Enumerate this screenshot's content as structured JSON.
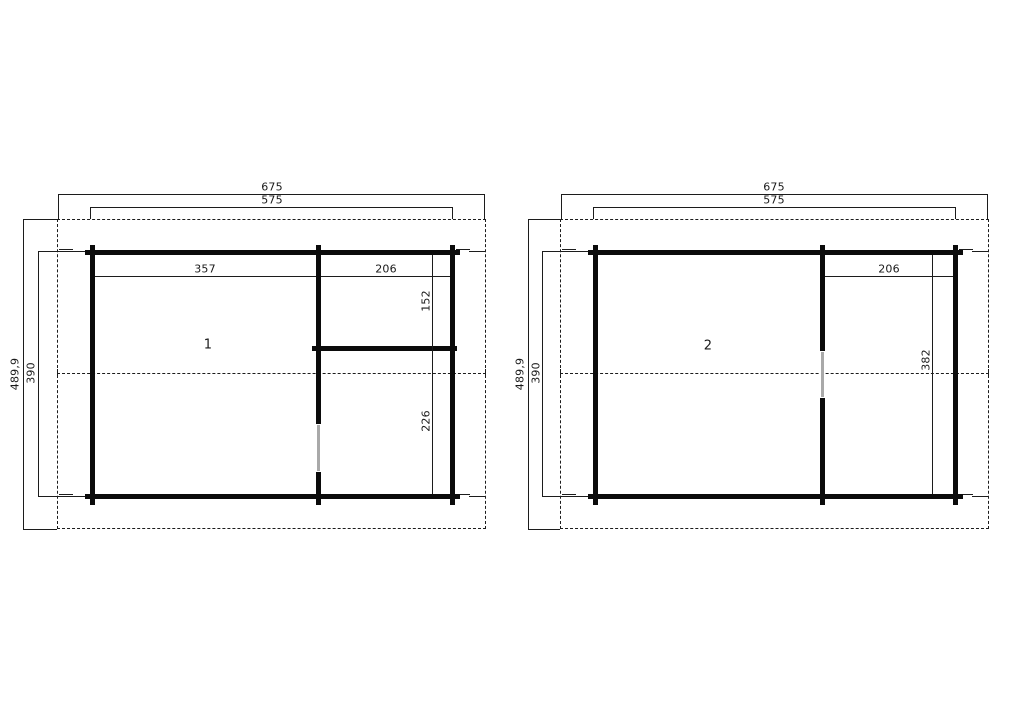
{
  "colors": {
    "line": "#1c1c1c",
    "wall": "#0b0b0b",
    "door": "#a9a9a9",
    "text": "#1a1a1a",
    "background": "#ffffff"
  },
  "plans": [
    {
      "room_label": "1",
      "dims": {
        "overall_width": "675",
        "building_width": "575",
        "overall_depth": "489,9",
        "building_depth": "390",
        "left_room_width": "357",
        "right_room_width": "206",
        "right_room_top_depth": "152",
        "right_room_bottom_depth": "226"
      }
    },
    {
      "room_label": "2",
      "dims": {
        "overall_width": "675",
        "building_width": "575",
        "overall_depth": "489,9",
        "building_depth": "390",
        "right_room_width": "206",
        "right_room_depth": "382"
      }
    }
  ]
}
